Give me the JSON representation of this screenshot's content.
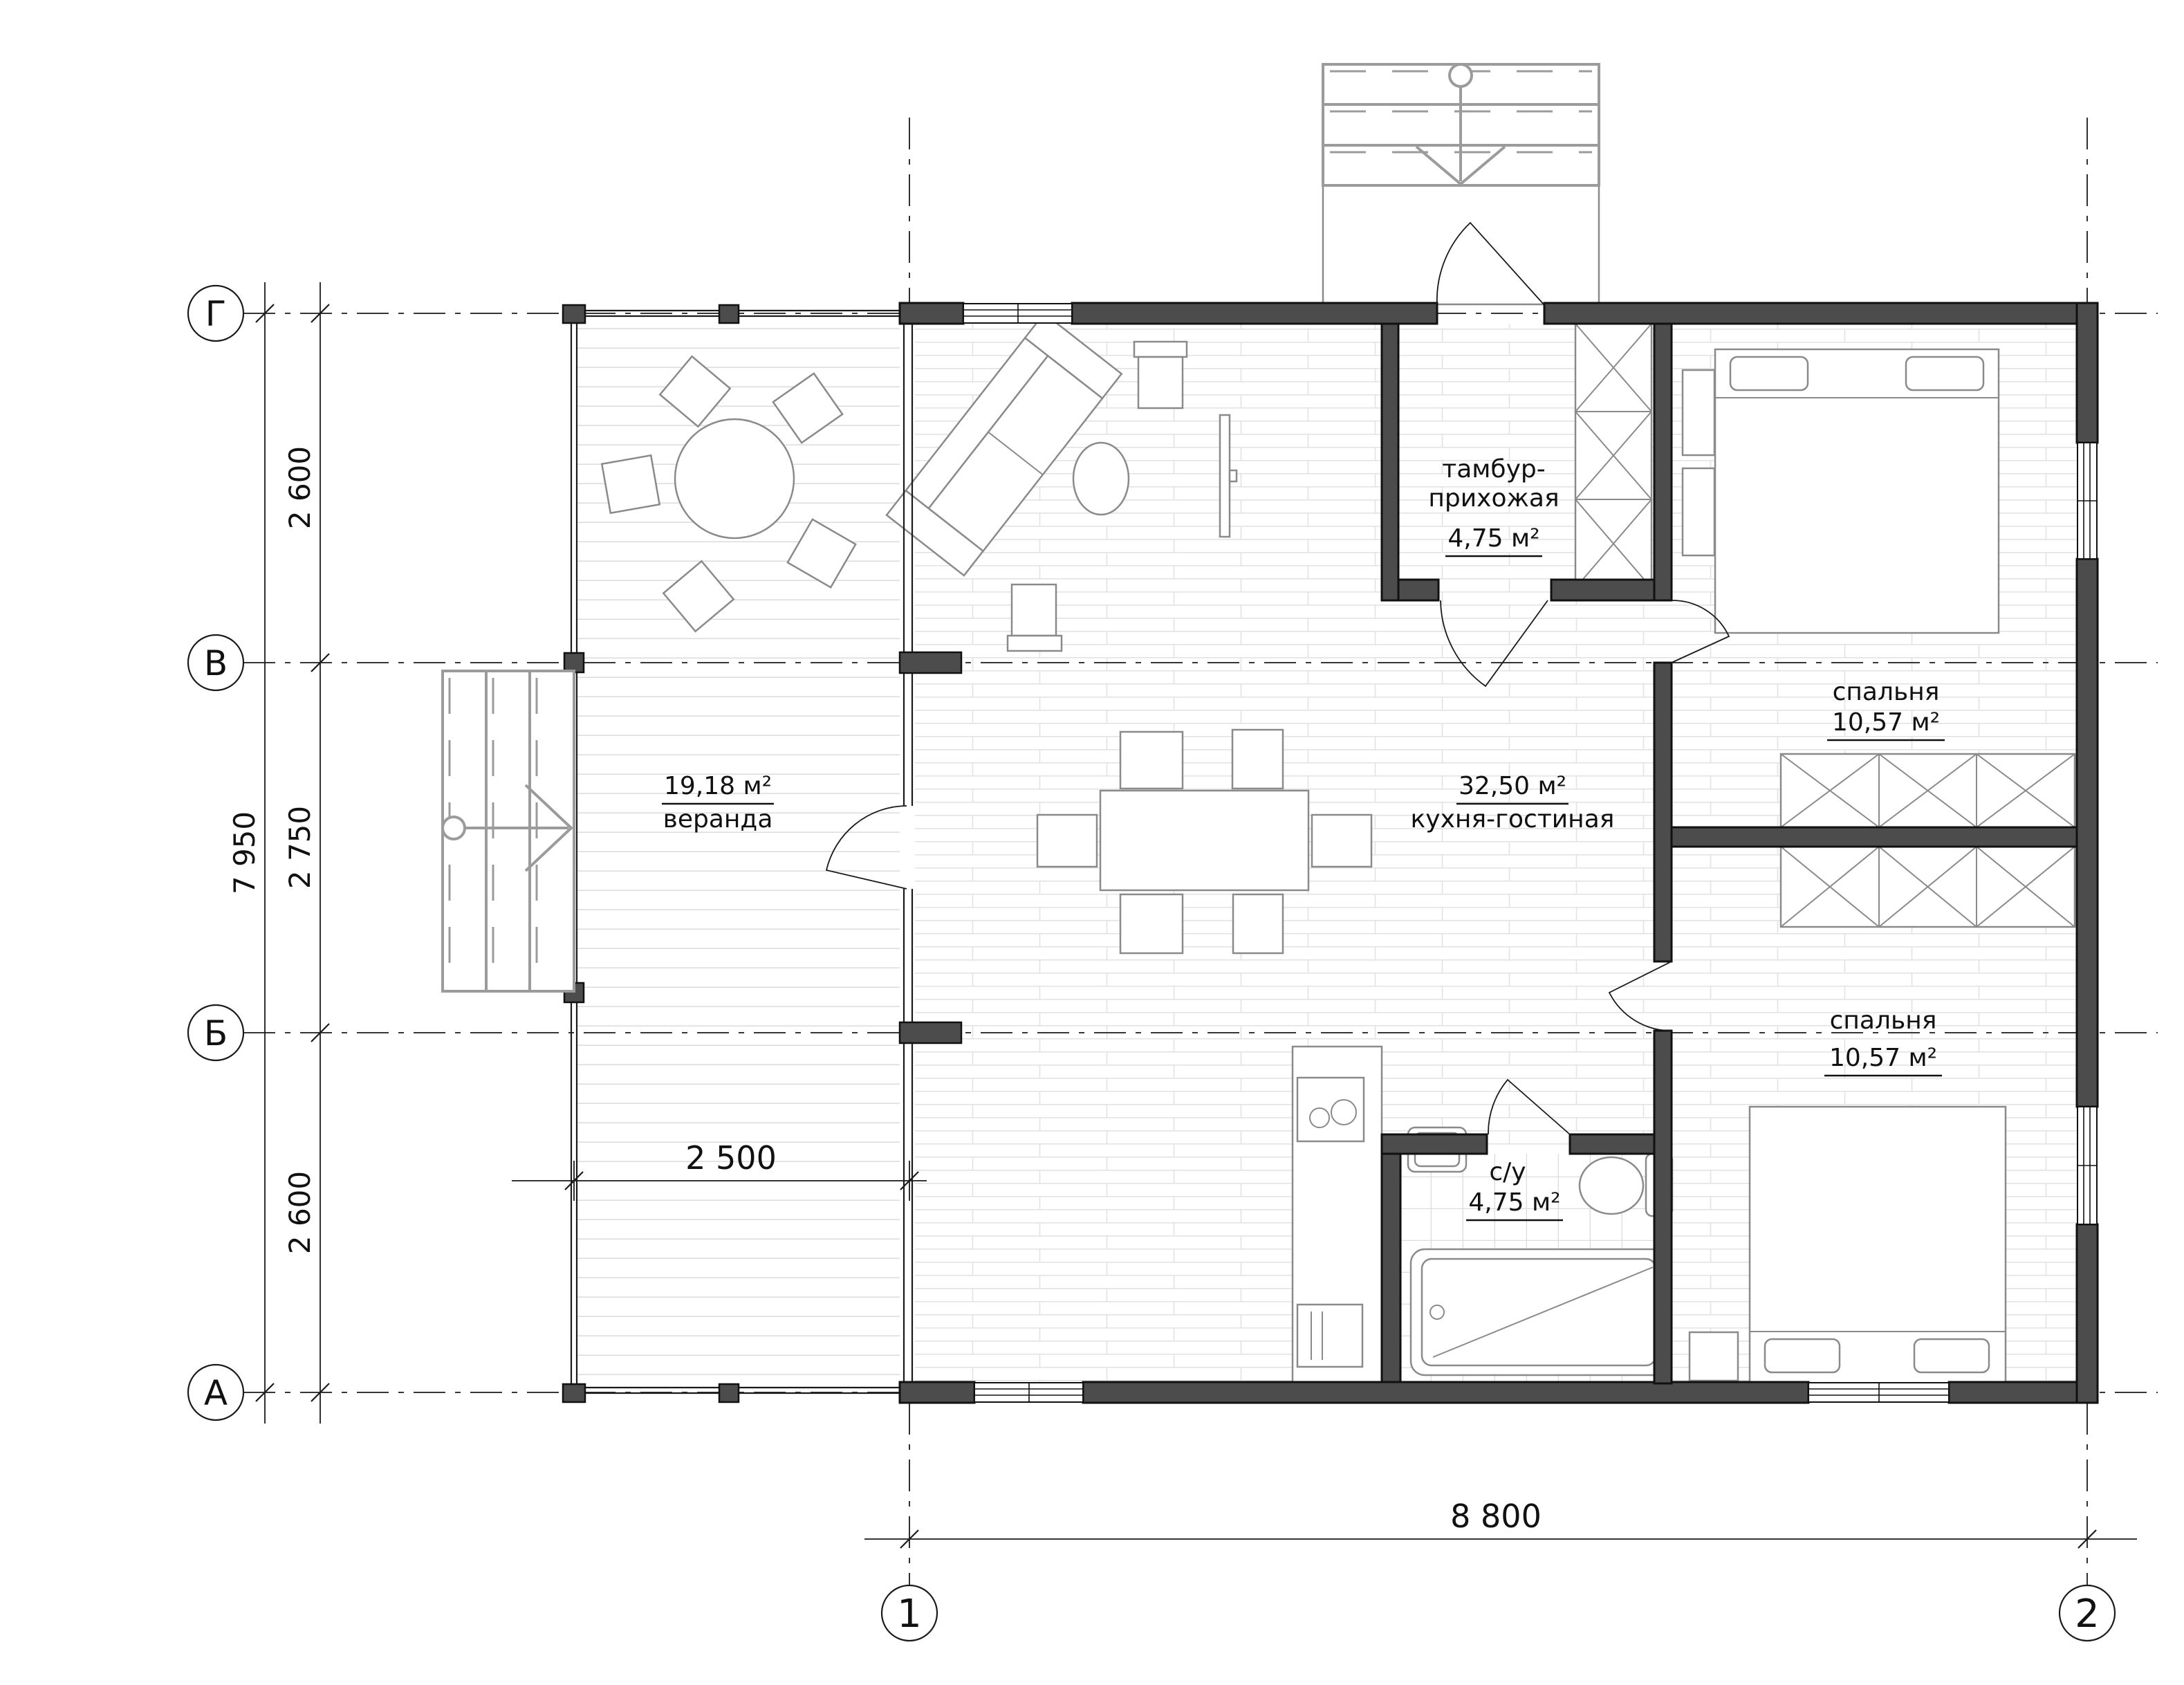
{
  "axes": {
    "horizontal": [
      {
        "label": "Г"
      },
      {
        "label": "В"
      },
      {
        "label": "Б"
      },
      {
        "label": "А"
      }
    ],
    "vertical": [
      {
        "label": "1"
      },
      {
        "label": "2"
      }
    ]
  },
  "dimensions": {
    "left_total": "7 950",
    "left_segments": [
      "2 600",
      "2 750",
      "2 600"
    ],
    "veranda_width": "2 500",
    "bottom_total": "8 800"
  },
  "rooms": {
    "veranda": {
      "name": "веранда",
      "area": "19,18 м²"
    },
    "kitchen_living": {
      "name": "кухня-гостиная",
      "area": "32,50 м²"
    },
    "tambour": {
      "name": [
        "тамбур-",
        "прихожая"
      ],
      "area": "4,75 м²"
    },
    "bedroom_top": {
      "name": "спальня",
      "area": "10,57 м²"
    },
    "bedroom_bottom": {
      "name": "спальня",
      "area": "10,57 м²"
    },
    "bathroom": {
      "name": "с/у",
      "area": "4,75 м²"
    }
  },
  "colors": {
    "wall": "#4c4c4c",
    "wall_stroke": "#111111",
    "floor_line": "#e3e3e3",
    "tile_line": "#dcdcdc",
    "furniture": "#8a8a8a",
    "stairs": "#9b9b9b",
    "text": "#111111",
    "bg": "#ffffff"
  }
}
